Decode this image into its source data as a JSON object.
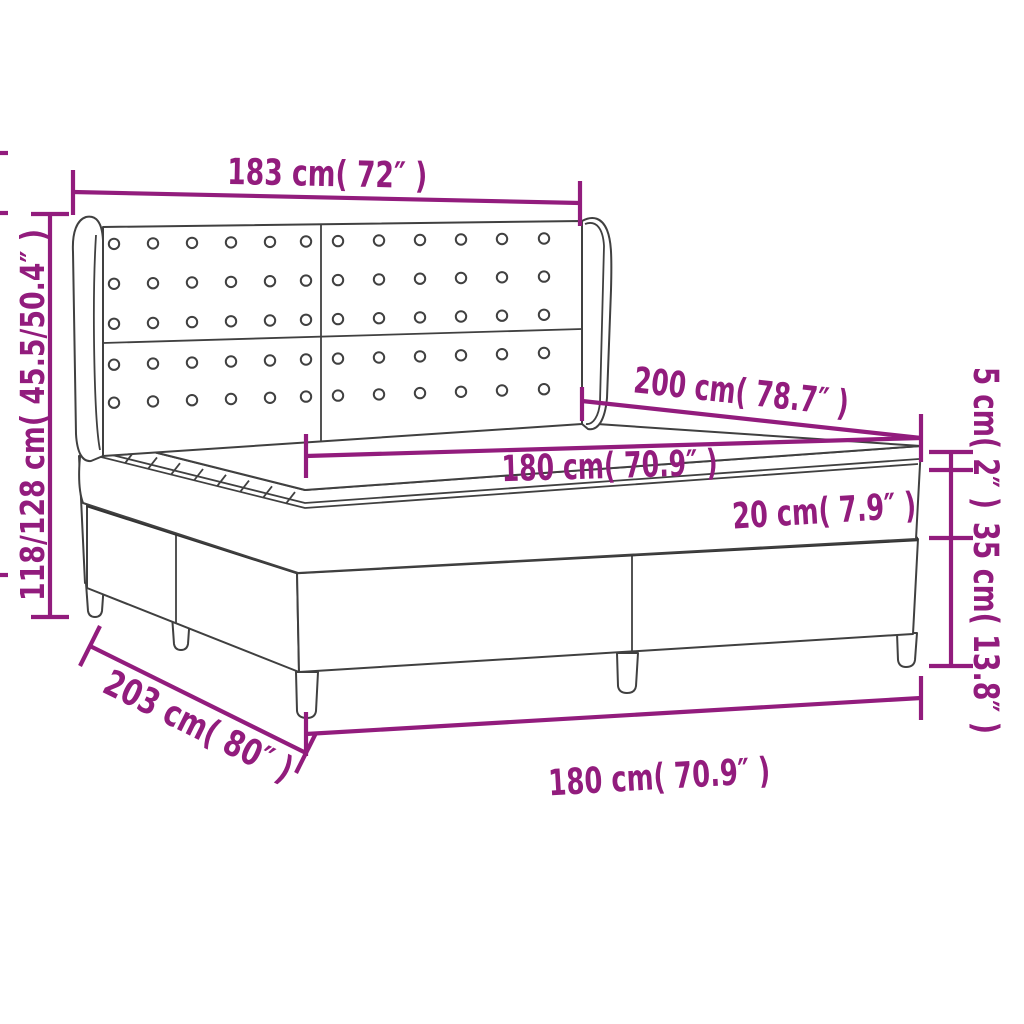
{
  "figure": {
    "type": "product-dimension-diagram",
    "product": "box spring bed with tufted wingback headboard",
    "colors": {
      "dimension_accent": "#921c7d",
      "drawing_outline": "#404040",
      "background": "#ffffff"
    },
    "headboard_buttons": {
      "rows": 5,
      "cols_per_panel": 6,
      "panels": 2
    }
  },
  "dimensions": {
    "headboard_width": "183 cm( 72″ )",
    "total_height": "118/128 cm( 45.5/50.4″ )",
    "mattress_length": "200 cm( 78.7″ )",
    "mattress_width_top": "180 cm( 70.9″ )",
    "mattress_height": "20 cm( 7.9″ )",
    "topper_height": "5 cm( 2″ )",
    "base_height": "35 cm( 13.8″ )",
    "total_length": "203 cm( 80″ )",
    "base_width_bottom": "180 cm( 70.9″ )"
  }
}
